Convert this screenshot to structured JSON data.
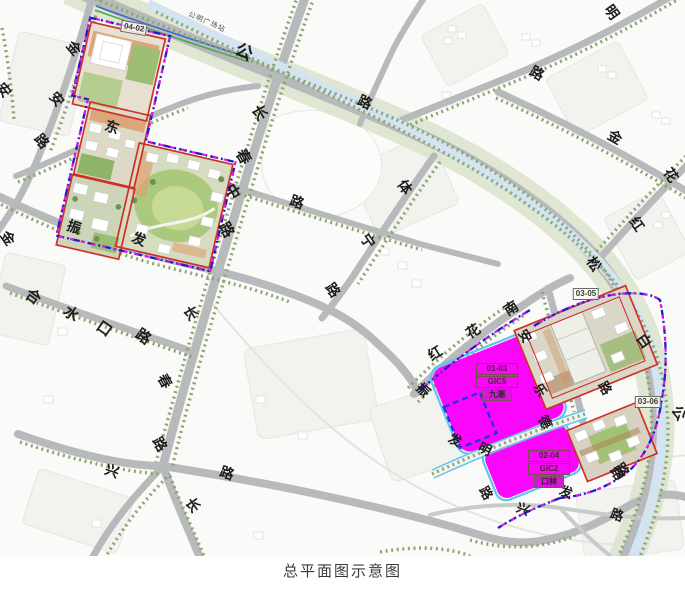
{
  "caption": "总平面图示意图",
  "station_label": {
    "text": "公明广场站",
    "x": 207,
    "y": 22,
    "rot": 24
  },
  "colors": {
    "magenta_parcel": "#fa07fa",
    "parcel_outline_red": "#d03028",
    "boundary_blue": "#1c1ccf",
    "boundary_magenta": "#e316d9",
    "road_gray": "#b7b9ba",
    "river_blue": "#d4e3f0",
    "tree_green": "#8aa773",
    "lawn_green": "#abc97c"
  },
  "plot_labels": [
    {
      "text": "04-02",
      "x": 134,
      "y": 28,
      "rot": 10
    },
    {
      "text": "03-05",
      "x": 586,
      "y": 294,
      "rot": 0
    },
    {
      "text": "03-06",
      "x": 648,
      "y": 402,
      "rot": 0
    }
  ],
  "parcel_stacks": [
    {
      "x": 497,
      "y": 382,
      "rows": [
        "01-03",
        "GIC5",
        "九潮"
      ]
    },
    {
      "x": 549,
      "y": 469,
      "rows": [
        "02-04",
        "GIC2",
        "口林"
      ]
    }
  ],
  "road_labels": [
    {
      "t": "金",
      "x": 74,
      "y": 48,
      "r": 50,
      "s": 14
    },
    {
      "t": "安",
      "x": 4,
      "y": 90,
      "r": 50,
      "s": 14
    },
    {
      "t": "安",
      "x": 57,
      "y": 99,
      "r": 50,
      "s": 14
    },
    {
      "t": "路",
      "x": 42,
      "y": 141,
      "r": 50,
      "s": 14
    },
    {
      "t": "东",
      "x": 112,
      "y": 127,
      "r": 20,
      "s": 14
    },
    {
      "t": "振",
      "x": 74,
      "y": 227,
      "r": 20,
      "s": 14
    },
    {
      "t": "发",
      "x": 139,
      "y": 239,
      "r": 20,
      "s": 14
    },
    {
      "t": "金",
      "x": 8,
      "y": 238,
      "r": 55,
      "s": 14
    },
    {
      "t": "长",
      "x": 259,
      "y": 113,
      "r": 60,
      "s": 15
    },
    {
      "t": "春",
      "x": 243,
      "y": 157,
      "r": 60,
      "s": 15
    },
    {
      "t": "中",
      "x": 232,
      "y": 192,
      "r": 60,
      "s": 15
    },
    {
      "t": "路",
      "x": 226,
      "y": 230,
      "r": 60,
      "s": 15
    },
    {
      "t": "公",
      "x": 244,
      "y": 52,
      "r": 25,
      "s": 17
    },
    {
      "t": "路",
      "x": 365,
      "y": 102,
      "r": 25,
      "s": 14
    },
    {
      "t": "体",
      "x": 405,
      "y": 187,
      "r": 55,
      "s": 14
    },
    {
      "t": "宁",
      "x": 368,
      "y": 241,
      "r": 55,
      "s": 14
    },
    {
      "t": "路",
      "x": 333,
      "y": 290,
      "r": 55,
      "s": 14
    },
    {
      "t": "路",
      "x": 297,
      "y": 202,
      "r": 20,
      "s": 14
    },
    {
      "t": "合",
      "x": 33,
      "y": 297,
      "r": 35,
      "s": 15
    },
    {
      "t": "水",
      "x": 71,
      "y": 314,
      "r": 35,
      "s": 15
    },
    {
      "t": "口",
      "x": 104,
      "y": 329,
      "r": 35,
      "s": 15
    },
    {
      "t": "路",
      "x": 143,
      "y": 337,
      "r": 35,
      "s": 15
    },
    {
      "t": "长",
      "x": 191,
      "y": 313,
      "r": 60,
      "s": 14
    },
    {
      "t": "春",
      "x": 165,
      "y": 381,
      "r": 60,
      "s": 14
    },
    {
      "t": "路",
      "x": 160,
      "y": 444,
      "r": 60,
      "s": 14
    },
    {
      "t": "兴",
      "x": 112,
      "y": 471,
      "r": 20,
      "s": 14
    },
    {
      "t": "路",
      "x": 227,
      "y": 473,
      "r": 20,
      "s": 14
    },
    {
      "t": "长",
      "x": 193,
      "y": 505,
      "r": 55,
      "s": 14
    },
    {
      "t": "明",
      "x": 612,
      "y": 12,
      "r": 55,
      "s": 14
    },
    {
      "t": "路",
      "x": 537,
      "y": 73,
      "r": 30,
      "s": 14
    },
    {
      "t": "金",
      "x": 615,
      "y": 137,
      "r": 30,
      "s": 14
    },
    {
      "t": "花",
      "x": 671,
      "y": 175,
      "r": 55,
      "s": 14
    },
    {
      "t": "红",
      "x": 637,
      "y": 224,
      "r": 55,
      "s": 14
    },
    {
      "t": "松",
      "x": 594,
      "y": 264,
      "r": 55,
      "s": 14
    },
    {
      "t": "白",
      "x": 644,
      "y": 341,
      "r": 55,
      "s": 14
    },
    {
      "t": "路",
      "x": 622,
      "y": 470,
      "r": 55,
      "s": 14
    },
    {
      "t": "公",
      "x": 679,
      "y": 413,
      "r": 55,
      "s": 14
    },
    {
      "t": "红",
      "x": 435,
      "y": 353,
      "r": -32,
      "s": 14
    },
    {
      "t": "花",
      "x": 473,
      "y": 331,
      "r": -32,
      "s": 14
    },
    {
      "t": "南",
      "x": 511,
      "y": 308,
      "r": -32,
      "s": 14
    },
    {
      "t": "安",
      "x": 525,
      "y": 336,
      "r": 60,
      "s": 13
    },
    {
      "t": "乐",
      "x": 540,
      "y": 390,
      "r": 60,
      "s": 13
    },
    {
      "t": "路",
      "x": 605,
      "y": 388,
      "r": 60,
      "s": 13
    },
    {
      "t": "德",
      "x": 545,
      "y": 422,
      "r": 60,
      "s": 13
    },
    {
      "t": "振",
      "x": 423,
      "y": 390,
      "r": 45,
      "s": 13
    },
    {
      "t": "发",
      "x": 455,
      "y": 440,
      "r": 25,
      "s": 13
    },
    {
      "t": "明",
      "x": 485,
      "y": 449,
      "r": 25,
      "s": 13
    },
    {
      "t": "路",
      "x": 486,
      "y": 493,
      "r": 60,
      "s": 13
    },
    {
      "t": "兴",
      "x": 523,
      "y": 509,
      "r": 20,
      "s": 13
    },
    {
      "t": "发",
      "x": 566,
      "y": 492,
      "r": 20,
      "s": 13
    },
    {
      "t": "路",
      "x": 617,
      "y": 473,
      "r": 55,
      "s": 13
    },
    {
      "t": "路",
      "x": 617,
      "y": 515,
      "r": 20,
      "s": 13
    }
  ]
}
